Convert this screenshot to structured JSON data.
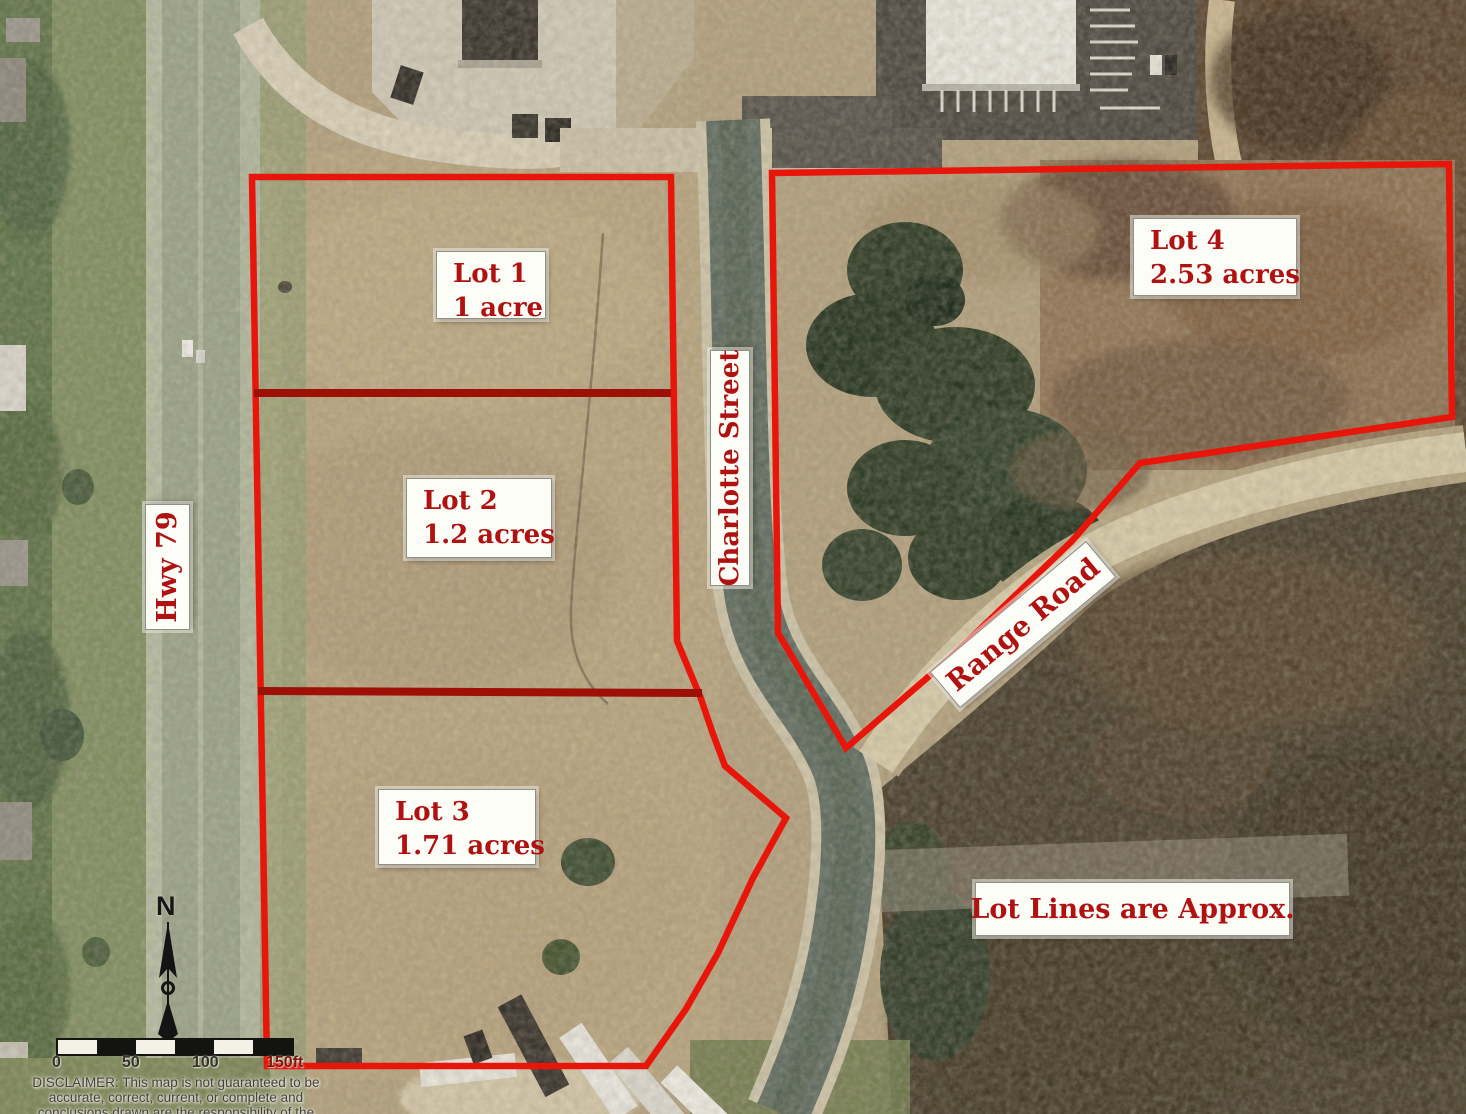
{
  "map": {
    "lots": [
      {
        "name": "Lot 1",
        "area": "1 acre"
      },
      {
        "name": "Lot 2",
        "area": "1.2 acres"
      },
      {
        "name": "Lot 3",
        "area": "1.71 acres"
      },
      {
        "name": "Lot 4",
        "area": "2.53 acres"
      }
    ],
    "roads": [
      {
        "label": "Hwy 79"
      },
      {
        "label": "Charlotte Street"
      },
      {
        "label": "Range Road"
      }
    ],
    "note": "Lot Lines are Approx.",
    "compass": {
      "north_label": "N"
    },
    "scale_bar": {
      "ticks": [
        "0",
        "50",
        "100",
        "150ft"
      ]
    },
    "disclaimer": {
      "line1": "DISCLAIMER: This map is not guaranteed to be",
      "line2": "accurate, correct, current, or complete and",
      "line3": "conclusions drawn are the responsibility of the"
    },
    "colors": {
      "boundary_red": "#e8150a",
      "divider_red": "#9e1006",
      "label_text_red": "#b01212",
      "label_bg": "#fdfdf8"
    }
  }
}
